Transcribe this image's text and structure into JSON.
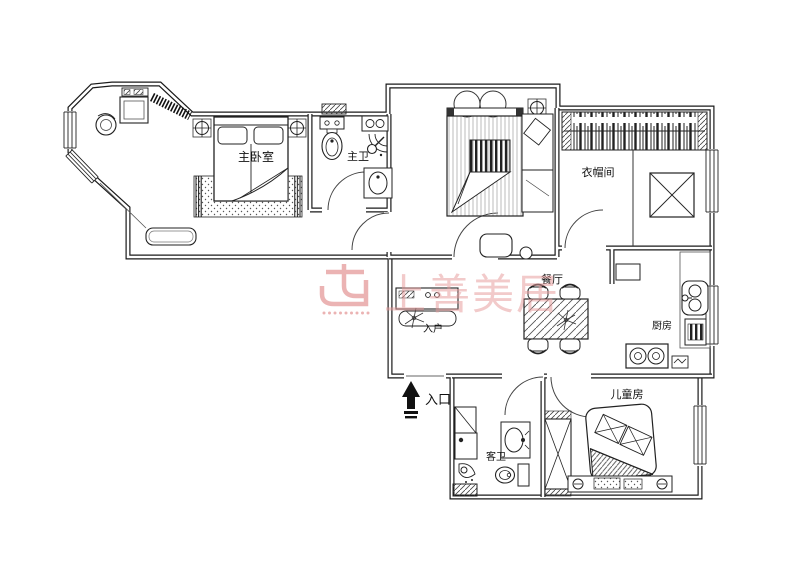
{
  "plan": {
    "rooms": {
      "master_bedroom": "主卧室",
      "master_bath": "主卫",
      "closet": "衣帽间",
      "dining": "餐厅",
      "kitchen": "厨房",
      "entry_hall": "入户",
      "entrance": "入口",
      "guest_bath": "客卫",
      "kids_room": "儿童房"
    },
    "watermark": {
      "text": "上善美居",
      "color": "#e59a9a"
    },
    "colors": {
      "line": "#1a1a1a",
      "background": "#ffffff"
    }
  }
}
